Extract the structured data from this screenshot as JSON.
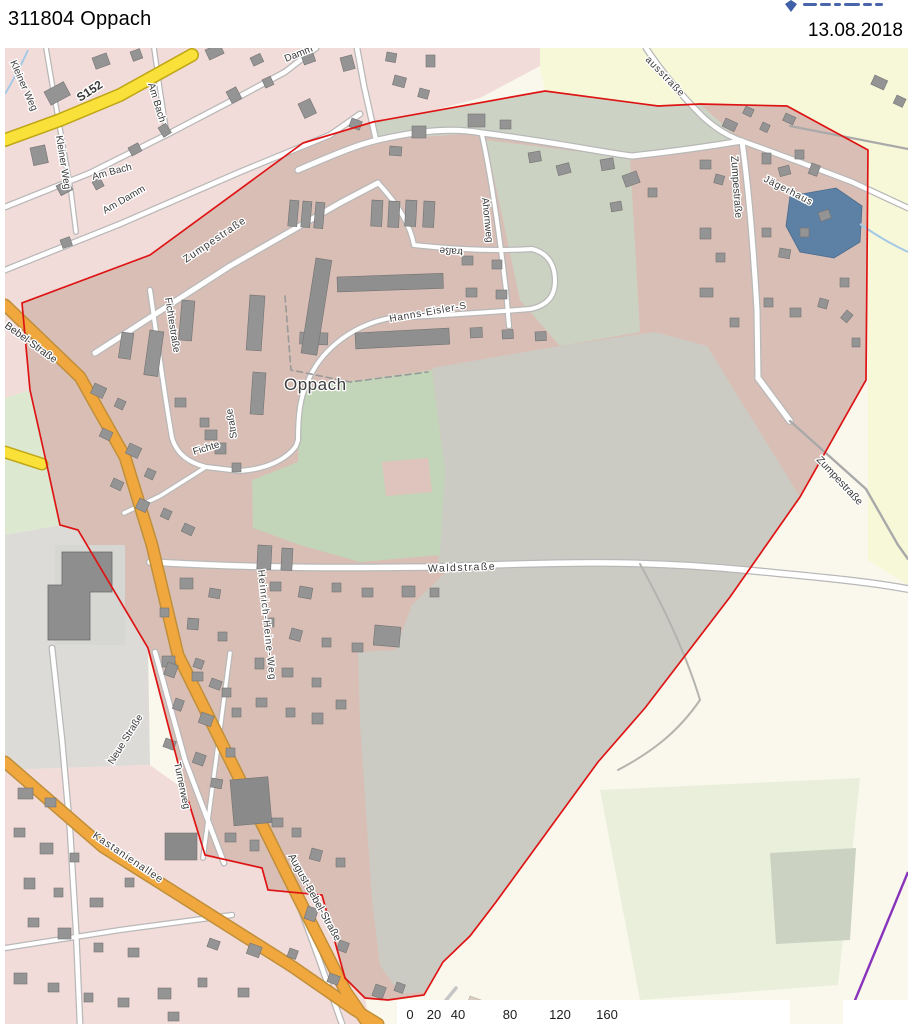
{
  "header": {
    "title": "311804 Oppach",
    "date": "13.08.2018",
    "logo_icon": "crest-icon"
  },
  "map": {
    "street_labels": [
      {
        "id": "s152",
        "text": "S152",
        "x": 80,
        "y": 102,
        "rot": -33,
        "size": 12,
        "weight": "bold"
      },
      {
        "id": "kleiner-weg-1",
        "text": "Kleiner Weg",
        "x": 10,
        "y": 62,
        "rot": 66,
        "size": 10
      },
      {
        "id": "kleiner-weg-2",
        "text": "Kleiner Weg",
        "x": 56,
        "y": 136,
        "rot": 81,
        "size": 10
      },
      {
        "id": "am-bach-1",
        "text": "Am Bach",
        "x": 148,
        "y": 84,
        "rot": 73,
        "size": 10
      },
      {
        "id": "am-bach-2",
        "text": "Am Bach",
        "x": 93,
        "y": 180,
        "rot": -15,
        "size": 10
      },
      {
        "id": "am-damm",
        "text": "Am Damm",
        "x": 105,
        "y": 214,
        "rot": -30,
        "size": 10
      },
      {
        "id": "damm",
        "text": "Damm",
        "x": 286,
        "y": 62,
        "rot": -22,
        "size": 10
      },
      {
        "id": "zumpestrasse-1",
        "text": "Zumpestraße",
        "x": 186,
        "y": 263,
        "rot": -34,
        "size": 10.5,
        "ls": 1
      },
      {
        "id": "zumpestrasse-2",
        "text": "Zumpestraße",
        "x": 731,
        "y": 156,
        "rot": 86,
        "size": 10.5
      },
      {
        "id": "zumpestrasse-3",
        "text": "Zumpestraße",
        "x": 816,
        "y": 460,
        "rot": 47,
        "size": 10.5
      },
      {
        "id": "fichtestrasse",
        "text": "Fichtestraße",
        "x": 165,
        "y": 298,
        "rot": 81,
        "size": 10
      },
      {
        "id": "fichtestrasse-2",
        "text": "Straße",
        "x": 237,
        "y": 438,
        "rot": -99,
        "size": 10
      },
      {
        "id": "fichte",
        "text": "Fichte",
        "x": 194,
        "y": 455,
        "rot": -17,
        "size": 10
      },
      {
        "id": "hanns-eisler-strasse",
        "text": "Hanns-Eisler-S",
        "x": 390,
        "y": 322,
        "rot": -10,
        "size": 10,
        "ls": 0.8
      },
      {
        "id": "hanns-eisler-strasse-2",
        "text": "traße",
        "x": 463,
        "y": 249,
        "rot": 184,
        "size": 10
      },
      {
        "id": "ahornweg",
        "text": "Ahornweg",
        "x": 482,
        "y": 198,
        "rot": 84,
        "size": 10
      },
      {
        "id": "hausstrasse",
        "text": "ausstraße",
        "x": 645,
        "y": 60,
        "rot": 46,
        "size": 10,
        "ls": 0.8
      },
      {
        "id": "jaegerhaus",
        "text": "Jägerhaus",
        "x": 763,
        "y": 181,
        "rot": 27,
        "size": 10,
        "ls": 0.8
      },
      {
        "id": "waldstrasse",
        "text": "Waldstraße",
        "x": 428,
        "y": 572,
        "rot": -2,
        "size": 10.5,
        "ls": 1.5
      },
      {
        "id": "heinrich-heine-weg",
        "text": "Heinrich-Heine-Weg",
        "x": 258,
        "y": 570,
        "rot": 84,
        "size": 10,
        "ls": 1.2
      },
      {
        "id": "neue-strasse",
        "text": "Neue Straße",
        "x": 113,
        "y": 765,
        "rot": -58,
        "size": 10
      },
      {
        "id": "turnerweg",
        "text": "Turnerweg",
        "x": 174,
        "y": 763,
        "rot": 78,
        "size": 10
      },
      {
        "id": "kastanienallee",
        "text": "Kastanienallee",
        "x": 92,
        "y": 837,
        "rot": 34,
        "size": 10.5,
        "ls": 1
      },
      {
        "id": "august-bebel-strasse",
        "text": "August-Bebel-Straße",
        "x": 288,
        "y": 856,
        "rot": 61,
        "size": 10.5
      },
      {
        "id": "bebel-strasse",
        "text": "Bebel-Straße",
        "x": 4,
        "y": 327,
        "rot": 36,
        "size": 10.5
      },
      {
        "id": "place-oppach",
        "text": "Oppach",
        "x": 284,
        "y": 390,
        "rot": 0,
        "size": 17,
        "ls": 0.5,
        "color": "#3d3d3d"
      }
    ],
    "scale_bar": {
      "values": [
        "0",
        "20",
        "40",
        "80",
        "120",
        "160"
      ],
      "x": [
        410,
        434,
        458,
        510,
        560,
        607
      ]
    },
    "colors": {
      "boundary_red": "#de1414",
      "residential_outside_pink": "#f2dcd9",
      "residential_inside_mauve": "#d9beb5",
      "field_gray": "#cccbc3",
      "green_area": "#c2d5b8",
      "farmland_cream": "#f6f8d8",
      "water_blue": "#5d81a4",
      "road_orange": "#efa73e",
      "road_yellow": "#f9e139",
      "power_line_purple": "#8733bb"
    }
  }
}
